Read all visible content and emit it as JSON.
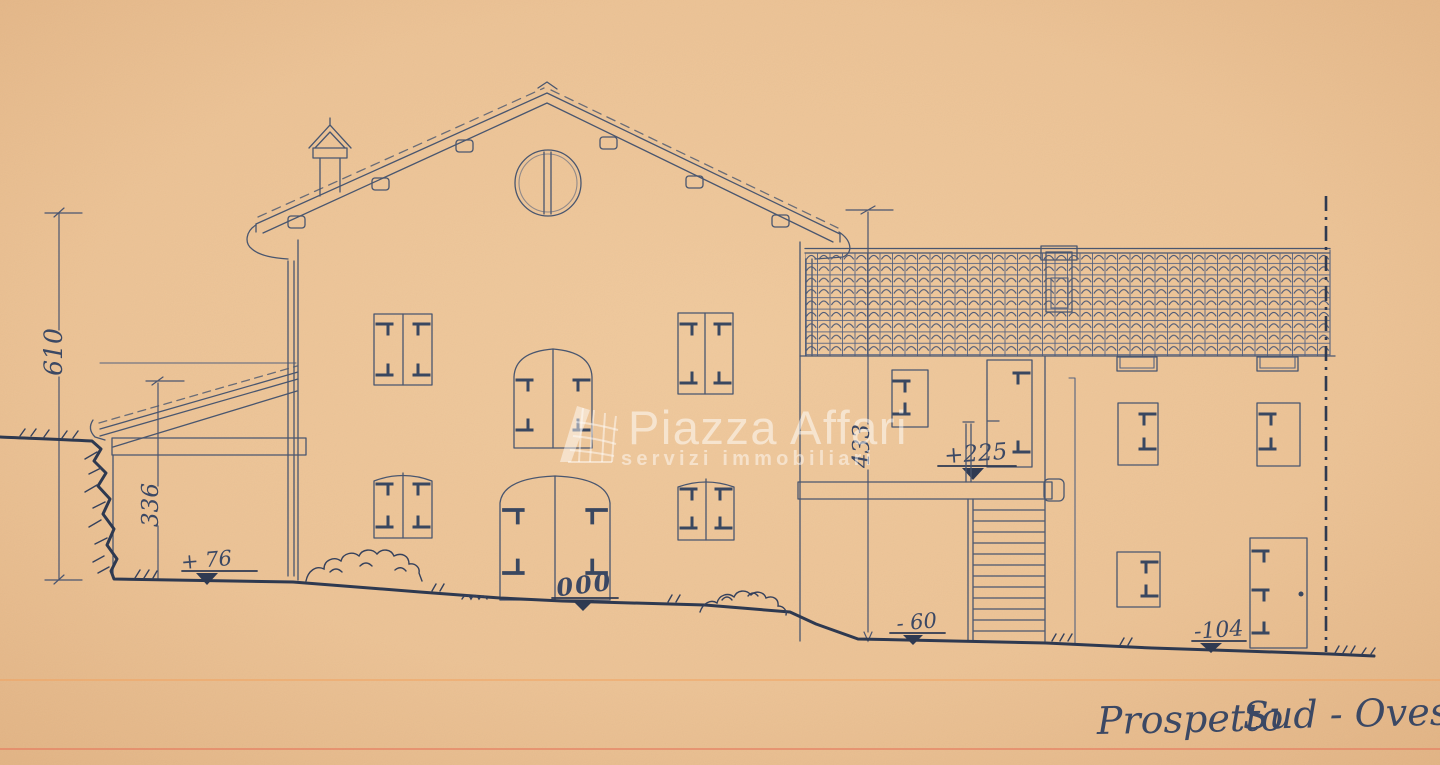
{
  "title": {
    "part1": "Prospetto",
    "part2": "Sud - Ovest"
  },
  "levels": {
    "total_height": "610",
    "leanto_height": "336",
    "annex_height": "433",
    "leanto_ground": "+ 76",
    "main_door": "000",
    "stair_landing": "+225",
    "stair_base": "- 60",
    "right_ground": "-104"
  },
  "watermark": {
    "brand": "Piazza Affari",
    "tagline": "servizi immobiliari"
  }
}
